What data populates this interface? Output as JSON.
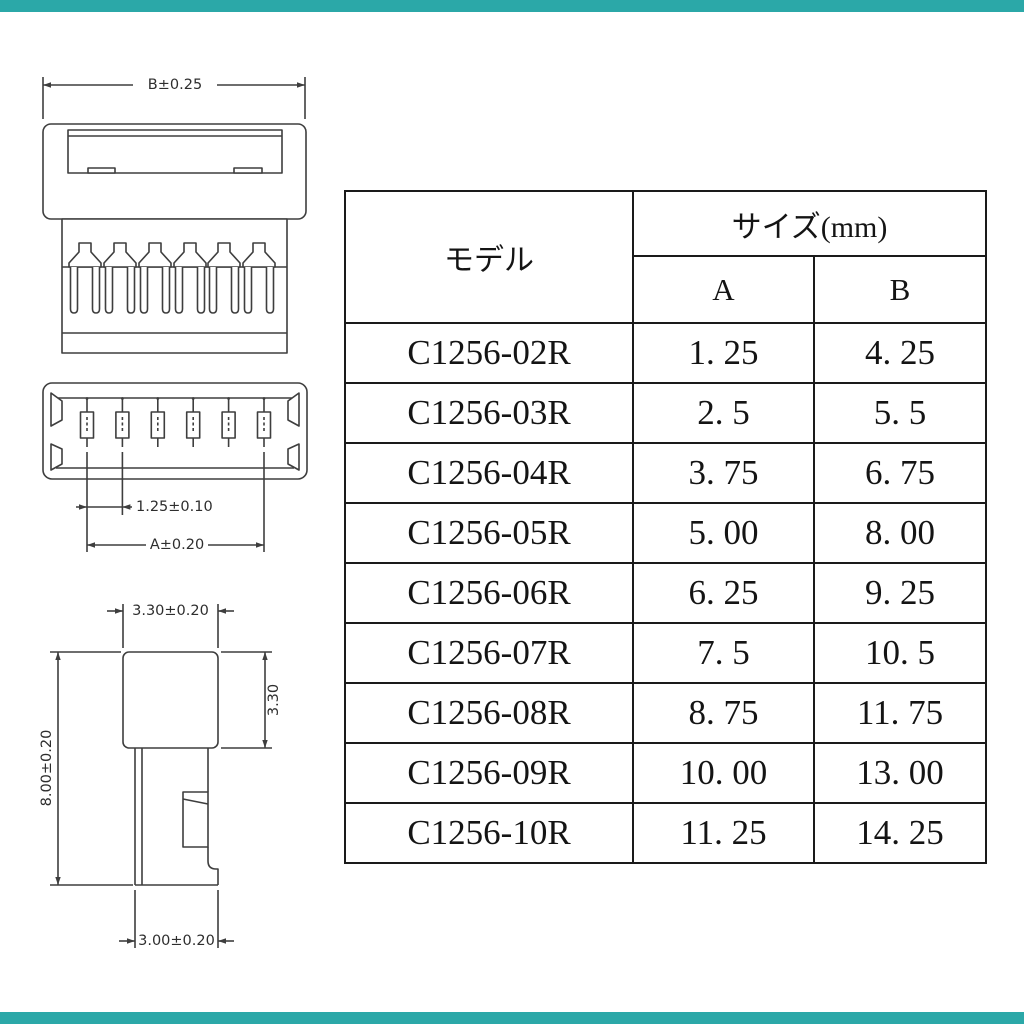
{
  "accent": {
    "bar_color": "#2ba8a8"
  },
  "drawings": {
    "line_color": "#3e3e3e",
    "top_view": {
      "dim_width": "B±0.25"
    },
    "front_view": {
      "dim_pitch": "1.25±0.10",
      "dim_span": "A±0.20"
    },
    "side_view": {
      "dim_head_width": "3.30±0.20",
      "dim_head_height": "3.30",
      "dim_total_height": "8.00±0.20",
      "dim_bottom_width": "3.00±0.20"
    }
  },
  "table": {
    "header": {
      "model": "モデル",
      "size": "サイズ(mm)",
      "col_a": "A",
      "col_b": "B"
    },
    "rows": [
      {
        "model": "C1256-02R",
        "a": "1. 25",
        "b": "4. 25"
      },
      {
        "model": "C1256-03R",
        "a": "2. 5",
        "b": "5. 5"
      },
      {
        "model": "C1256-04R",
        "a": "3. 75",
        "b": "6. 75"
      },
      {
        "model": "C1256-05R",
        "a": "5. 00",
        "b": "8. 00"
      },
      {
        "model": "C1256-06R",
        "a": "6. 25",
        "b": "9. 25"
      },
      {
        "model": "C1256-07R",
        "a": "7. 5",
        "b": "10. 5"
      },
      {
        "model": "C1256-08R",
        "a": "8. 75",
        "b": "11. 75"
      },
      {
        "model": "C1256-09R",
        "a": "10. 00",
        "b": "13. 00"
      },
      {
        "model": "C1256-10R",
        "a": "11. 25",
        "b": "14. 25"
      }
    ]
  }
}
